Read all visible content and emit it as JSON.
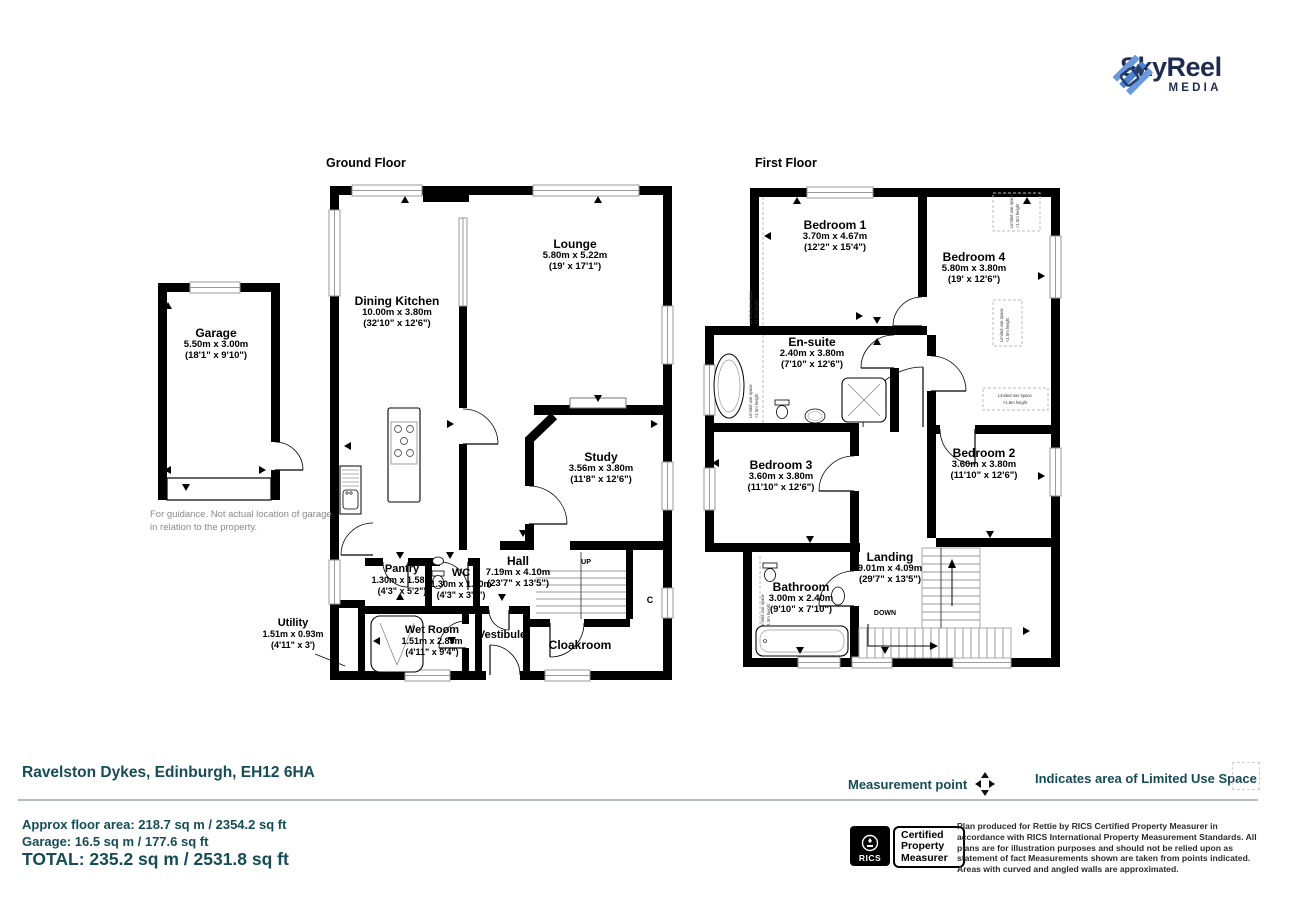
{
  "brand": {
    "name": "SkyReel",
    "sub": "MEDIA",
    "icon_blue": "#4d80d2",
    "navy": "#1e2c4f"
  },
  "floors": {
    "ground": {
      "title": "Ground Floor",
      "rooms": [
        {
          "name": "Dining Kitchen",
          "metric": "10.00m x 3.80m",
          "imperial": "(32'10\" x 12'6\")"
        },
        {
          "name": "Lounge",
          "metric": "5.80m x 5.22m",
          "imperial": "(19' x 17'1\")"
        },
        {
          "name": "Study",
          "metric": "3.56m x 3.80m",
          "imperial": "(11'8\" x 12'6\")"
        },
        {
          "name": "Hall",
          "metric": "7.19m x 4.10m",
          "imperial": "(23'7\" x 13'5\")"
        },
        {
          "name": "Pantry",
          "metric": "1.30m x 1.58m",
          "imperial": "(4'3\" x 5'2\")"
        },
        {
          "name": "WC",
          "metric": "1.30m x 1.10m",
          "imperial": "(4'3\" x 3'7\")"
        },
        {
          "name": "Utility",
          "metric": "1.51m x 0.93m",
          "imperial": "(4'11\" x 3')"
        },
        {
          "name": "Wet Room",
          "metric": "1.51m x 2.85m",
          "imperial": "(4'11\" x 9'4\")"
        },
        {
          "name": "Vestibule"
        },
        {
          "name": "Cloakroom"
        }
      ],
      "labels": {
        "up": "UP",
        "cupboard": "C"
      }
    },
    "first": {
      "title": "First Floor",
      "rooms": [
        {
          "name": "Bedroom 1",
          "metric": "3.70m x 4.67m",
          "imperial": "(12'2\" x 15'4\")"
        },
        {
          "name": "Bedroom 4",
          "metric": "5.80m x 3.80m",
          "imperial": "(19' x 12'6\")"
        },
        {
          "name": "En-suite",
          "metric": "2.40m x 3.80m",
          "imperial": "(7'10\" x 12'6\")"
        },
        {
          "name": "Bedroom 3",
          "metric": "3.60m x 3.80m",
          "imperial": "(11'10\" x 12'6\")"
        },
        {
          "name": "Bedroom 2",
          "metric": "3.60m x 3.80m",
          "imperial": "(11'10\" x 12'6\")"
        },
        {
          "name": "Landing",
          "metric": "9.01m x 4.09m",
          "imperial": "(29'7\" x 13'5\")"
        },
        {
          "name": "Bathroom",
          "metric": "3.00m x 2.40m",
          "imperial": "(9'10\" x 7'10\")"
        }
      ],
      "labels": {
        "down": "DOWN",
        "limited_line1": "Limited use space",
        "limited_line2": "<1.5m height"
      }
    },
    "garage": {
      "title": "Garage",
      "metric": "5.50m x 3.00m",
      "imperial": "(18'1\" x 9'10\")",
      "note_line1": "For guidance. Not actual location of garage",
      "note_line2": "in relation to the property."
    }
  },
  "legend": {
    "measurement_point": "Measurement point",
    "limited_use": "Indicates area of  Limited Use Space"
  },
  "summary": {
    "address": "Ravelston Dykes, Edinburgh, EH12 6HA",
    "approx": "Approx floor area: 218.7 sq m / 2354.2 sq ft",
    "garage": "Garage: 16.5 sq m / 177.6 sq ft",
    "total": "TOTAL: 235.2 sq m / 2531.8 sq ft",
    "accent": "#164c55"
  },
  "certification": {
    "org": "RICS",
    "badge_line1": "Certified",
    "badge_line2": "Property",
    "badge_line3": "Measurer",
    "disclaimer": "Plan produced for Rettie by RICS Certified Property Measurer in accordance with RICS International Property  Measurement Standards.  All plans are for illustration purposes and should not be relied upon as statement of fact Measurements shown are taken from points indicated. Areas with curved and angled walls are approximated."
  }
}
